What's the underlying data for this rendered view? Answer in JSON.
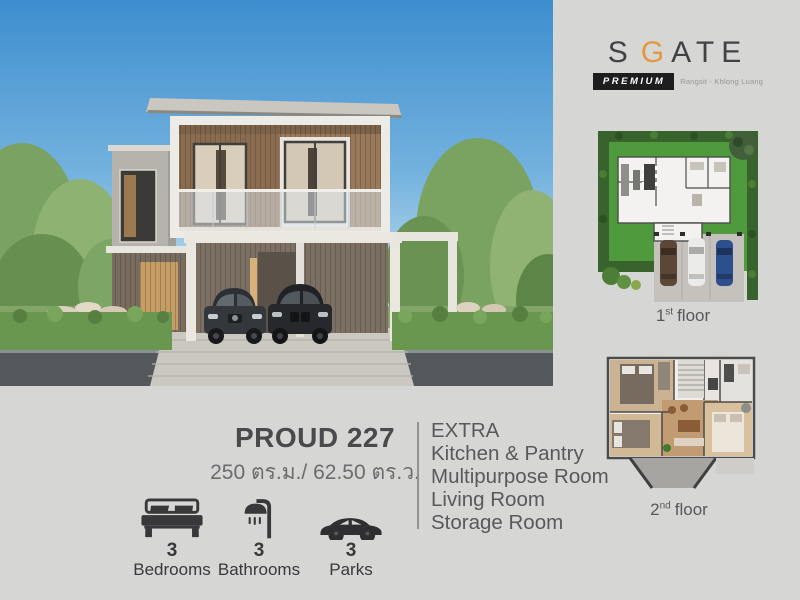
{
  "logo": {
    "part_s": "S",
    "part_g": "G",
    "part_ate": "ATE",
    "badge": "PREMIUM",
    "location": "Rangsit - Khlong Luang",
    "accent_color": "#e2993e"
  },
  "model": {
    "name": "PROUD 227",
    "area": "250 ตร.ม./ 62.50 ตร.ว."
  },
  "features": [
    {
      "icon": "bed-icon",
      "count": "3",
      "label": "Bedrooms"
    },
    {
      "icon": "shower-icon",
      "count": "3",
      "label": "Bathrooms"
    },
    {
      "icon": "car-icon",
      "count": "3",
      "label": "Parks"
    }
  ],
  "extra": {
    "title": "EXTRA",
    "items": [
      "Kitchen & Pantry",
      "Multipurpose Room",
      "Living Room",
      "Storage Room"
    ]
  },
  "floor_plans": [
    {
      "number": "1",
      "ordinal": "st",
      "word": "floor"
    },
    {
      "number": "2",
      "ordinal": "nd",
      "word": "floor"
    }
  ],
  "colors": {
    "background": "#d6d6d4",
    "text_dark": "#4a4a4c",
    "text_gray": "#6c6c6e",
    "lawn_green": "#4f9a3c",
    "hedge_green": "#39632c"
  }
}
